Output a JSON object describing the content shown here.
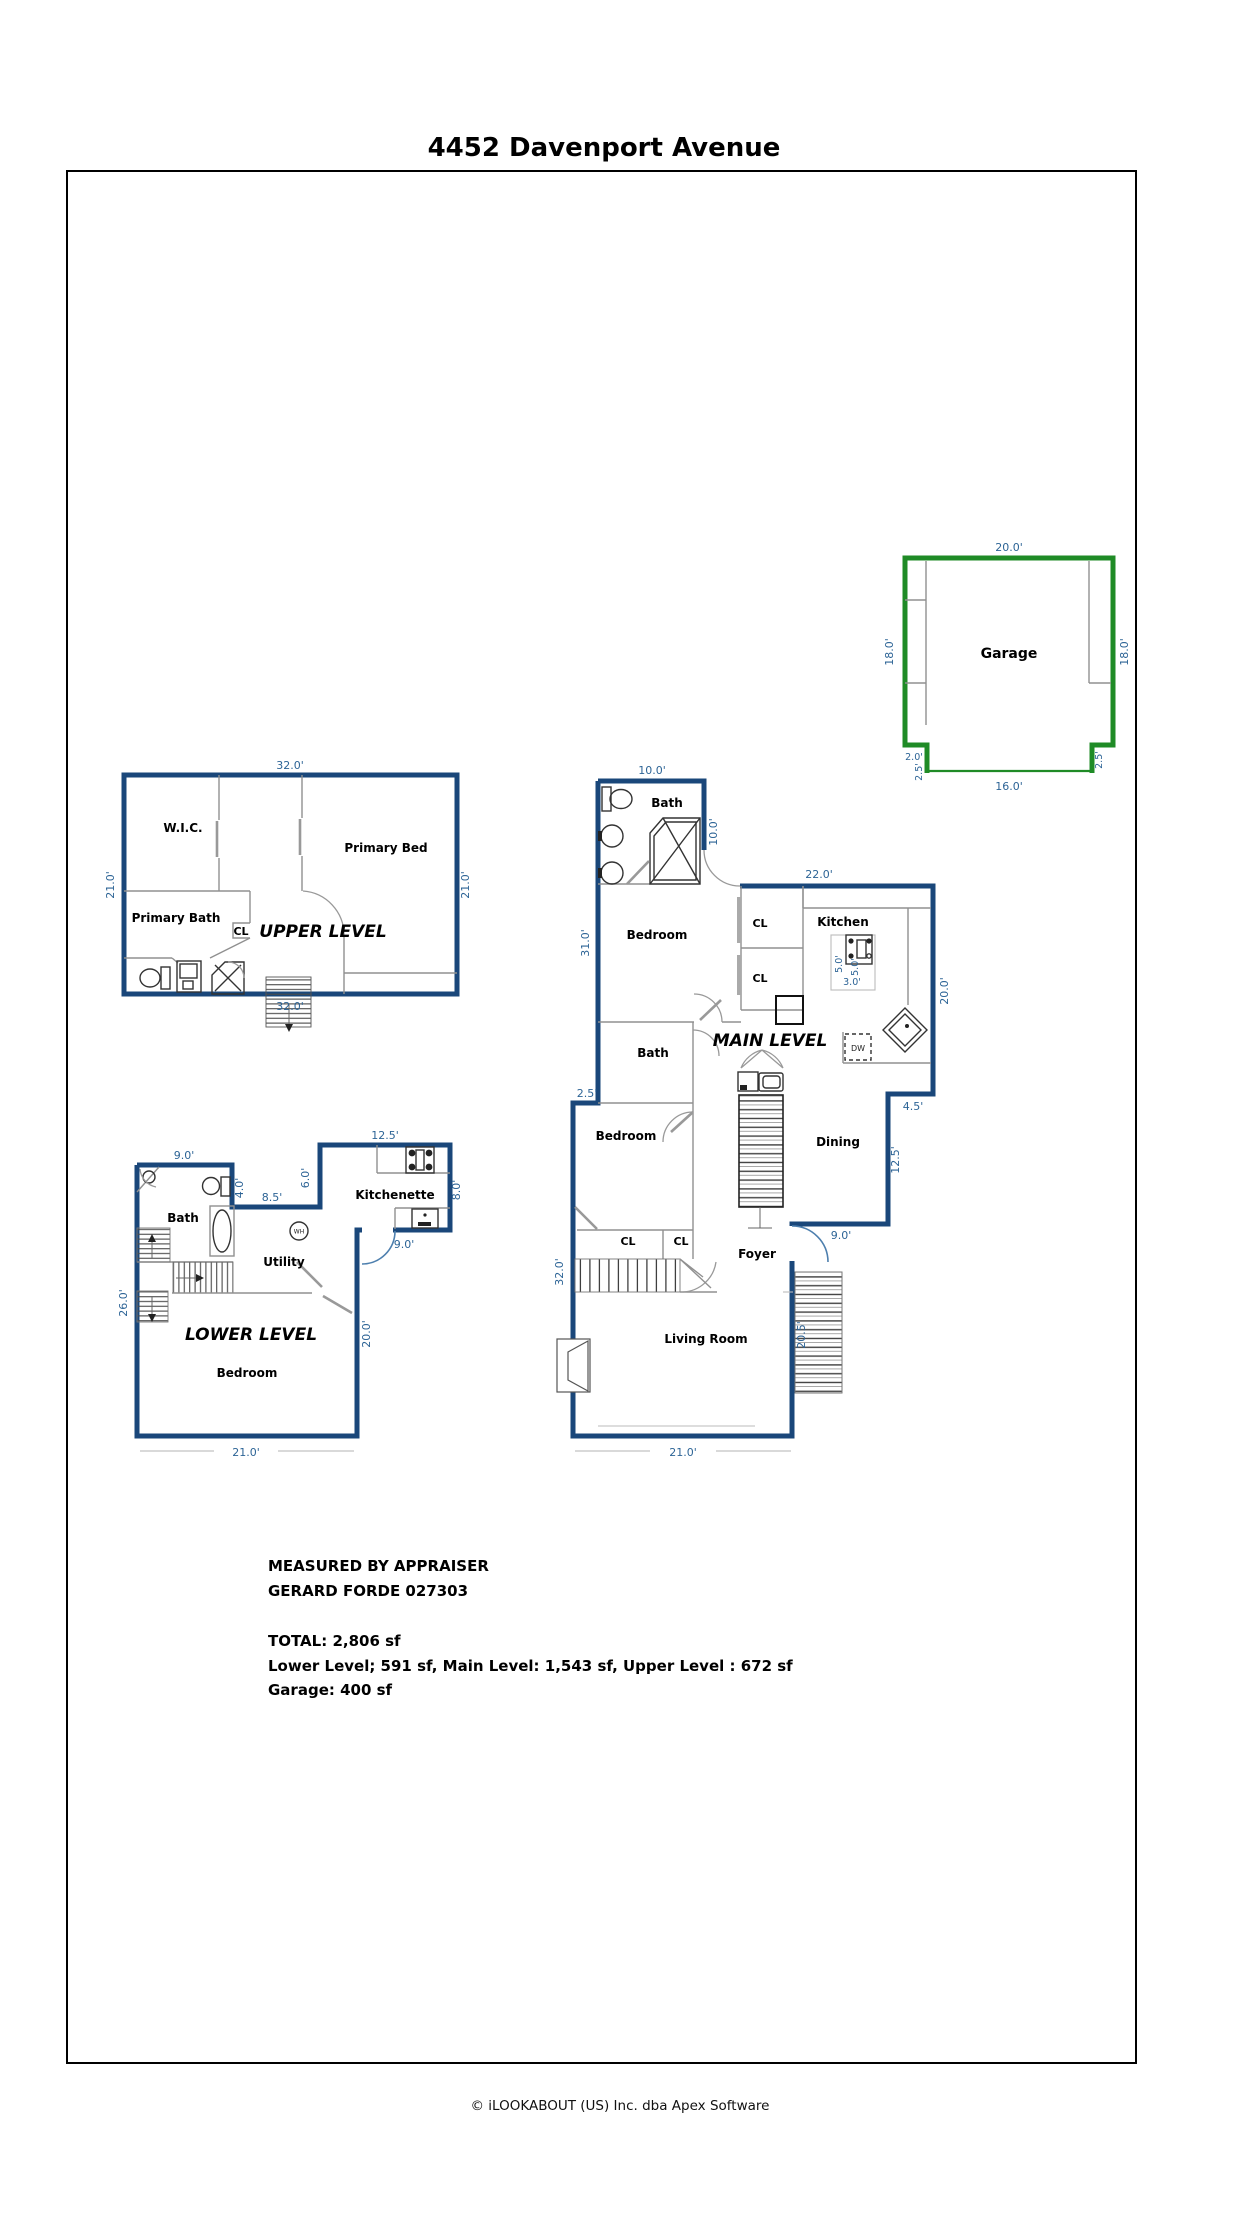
{
  "title": "4452 Davenport Avenue",
  "footer": "© iLOOKABOUT (US) Inc. dba Apex Software",
  "summary": {
    "measured_by": "MEASURED BY APPRAISER",
    "appraiser": "GERARD FORDE 027303",
    "total": "TOTAL: 2,806 sf",
    "levels": "Lower Level; 591 sf, Main Level: 1,543 sf, Upper Level : 672 sf",
    "garage_area": "Garage: 400 sf"
  },
  "colors": {
    "wall_blue": "#1a477a",
    "garage_green": "#1f8b26",
    "dimension_text": "#2d6496"
  },
  "garage": {
    "label": "Garage",
    "dim_top": "20.0'",
    "dim_left": "18.0'",
    "dim_right": "18.0'",
    "dim_bottom": "16.0'",
    "dim_notch_width": "2.0'",
    "dim_notch_left": "2.5'",
    "dim_notch_right": "2.5'"
  },
  "upper": {
    "label": "UPPER LEVEL",
    "wic": "W.I.C.",
    "primary_bed": "Primary Bed",
    "primary_bath": "Primary Bath",
    "cl": "CL",
    "dim_top": "32.0'",
    "dim_left": "21.0'",
    "dim_right": "21.0'",
    "dim_bottom": "32.0'"
  },
  "main": {
    "label": "MAIN LEVEL",
    "bath_top": "Bath",
    "bedroom_top": "Bedroom",
    "cl1": "CL",
    "cl2": "CL",
    "kitchen": "Kitchen",
    "bath_mid": "Bath",
    "bedroom_mid": "Bedroom",
    "dining": "Dining",
    "cl3": "CL",
    "cl4": "CL",
    "foyer": "Foyer",
    "living_room": "Living Room",
    "dw": "DW",
    "dim_bath_top": "10.0'",
    "dim_bath_right": "10.0'",
    "dim_kitchen_top": "22.0'",
    "dim_left_upper": "31.0'",
    "dim_kitchen_right": "20.0'",
    "dim_step": "4.5'",
    "dim_right_mid": "12.5'",
    "dim_foyer": "9.0'",
    "dim_left_step": "2.5'",
    "dim_left_lower": "32.0'",
    "dim_entry_side": "20.5'",
    "dim_bottom": "21.0'",
    "dim_counter_a": "5.0'",
    "dim_counter_b": "5.0'",
    "dim_counter_c": "3.0'"
  },
  "lower": {
    "label": "LOWER LEVEL",
    "bath": "Bath",
    "kitchenette": "Kitchenette",
    "utility": "Utility",
    "bedroom": "Bedroom",
    "wh": "WH",
    "dim_bath_top": "9.0'",
    "dim_bath_right": "4.0'",
    "dim_hall": "8.5'",
    "dim_kitchenette_left": "6.0'",
    "dim_kitchenette_top": "12.5'",
    "dim_kitchenette_right": "8.0'",
    "dim_kitchenette_bottom": "9.0'",
    "dim_right": "20.0'",
    "dim_left": "26.0'",
    "dim_bottom": "21.0'"
  }
}
